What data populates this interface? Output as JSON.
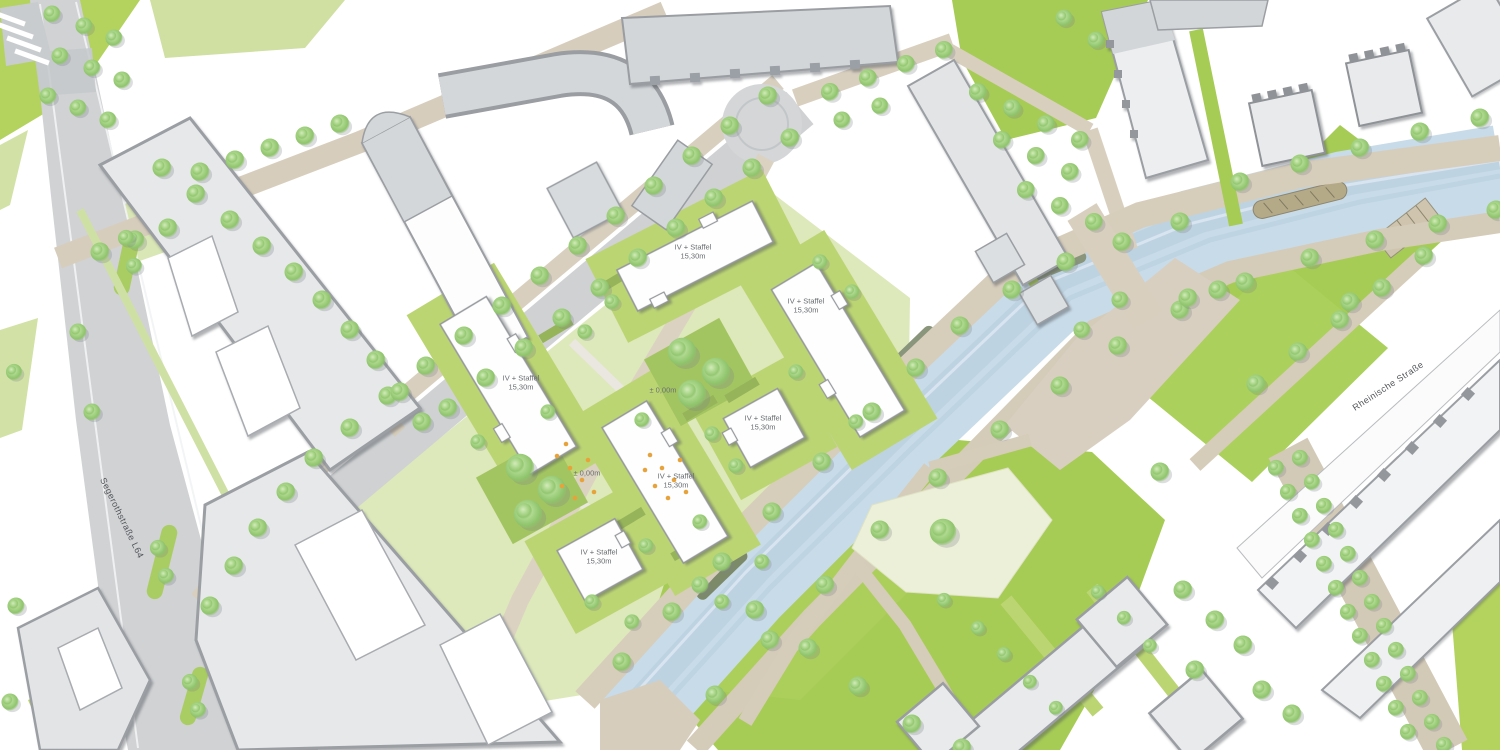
{
  "map": {
    "title": "urban-masterplan-site-plan",
    "street_labels": [
      {
        "id": "segerothstrasse",
        "text": "Segerothstraße L64",
        "x": 122,
        "y": 518,
        "rotation": 64
      },
      {
        "id": "rheinische-strasse",
        "text": "Rheinische Straße",
        "x": 1388,
        "y": 386,
        "rotation": -33
      }
    ],
    "building_labels": [
      {
        "line1": "IV + Staffel",
        "line2": "15,30m",
        "x": 693,
        "y": 252
      },
      {
        "line1": "IV + Staffel",
        "line2": "15,30m",
        "x": 806,
        "y": 306
      },
      {
        "line1": "IV + Staffel",
        "line2": "15,30m",
        "x": 521,
        "y": 383
      },
      {
        "line1": "IV + Staffel",
        "line2": "15,30m",
        "x": 763,
        "y": 423
      },
      {
        "line1": "IV + Staffel",
        "line2": "15,30m",
        "x": 676,
        "y": 481
      },
      {
        "line1": "IV + Staffel",
        "line2": "15,30m",
        "x": 599,
        "y": 557
      }
    ],
    "level_markers": [
      {
        "text": "± 0,00m",
        "x": 663,
        "y": 390
      },
      {
        "text": "± 0,00m",
        "x": 587,
        "y": 473
      }
    ],
    "colors": {
      "lawn": "#a6cc55",
      "garden": "#bcd573",
      "water": "#c8dbe8",
      "road": "#d0d2d4",
      "path": "#d7cdbc",
      "plaza": "#edf0d8",
      "building_context": "#e7e8ea",
      "building_new": "#fefefe",
      "roof_edge": "#9a9da1",
      "tree": "#8fc46c",
      "accent_dot": "#e7a33b",
      "label_text": "#686c70"
    }
  }
}
